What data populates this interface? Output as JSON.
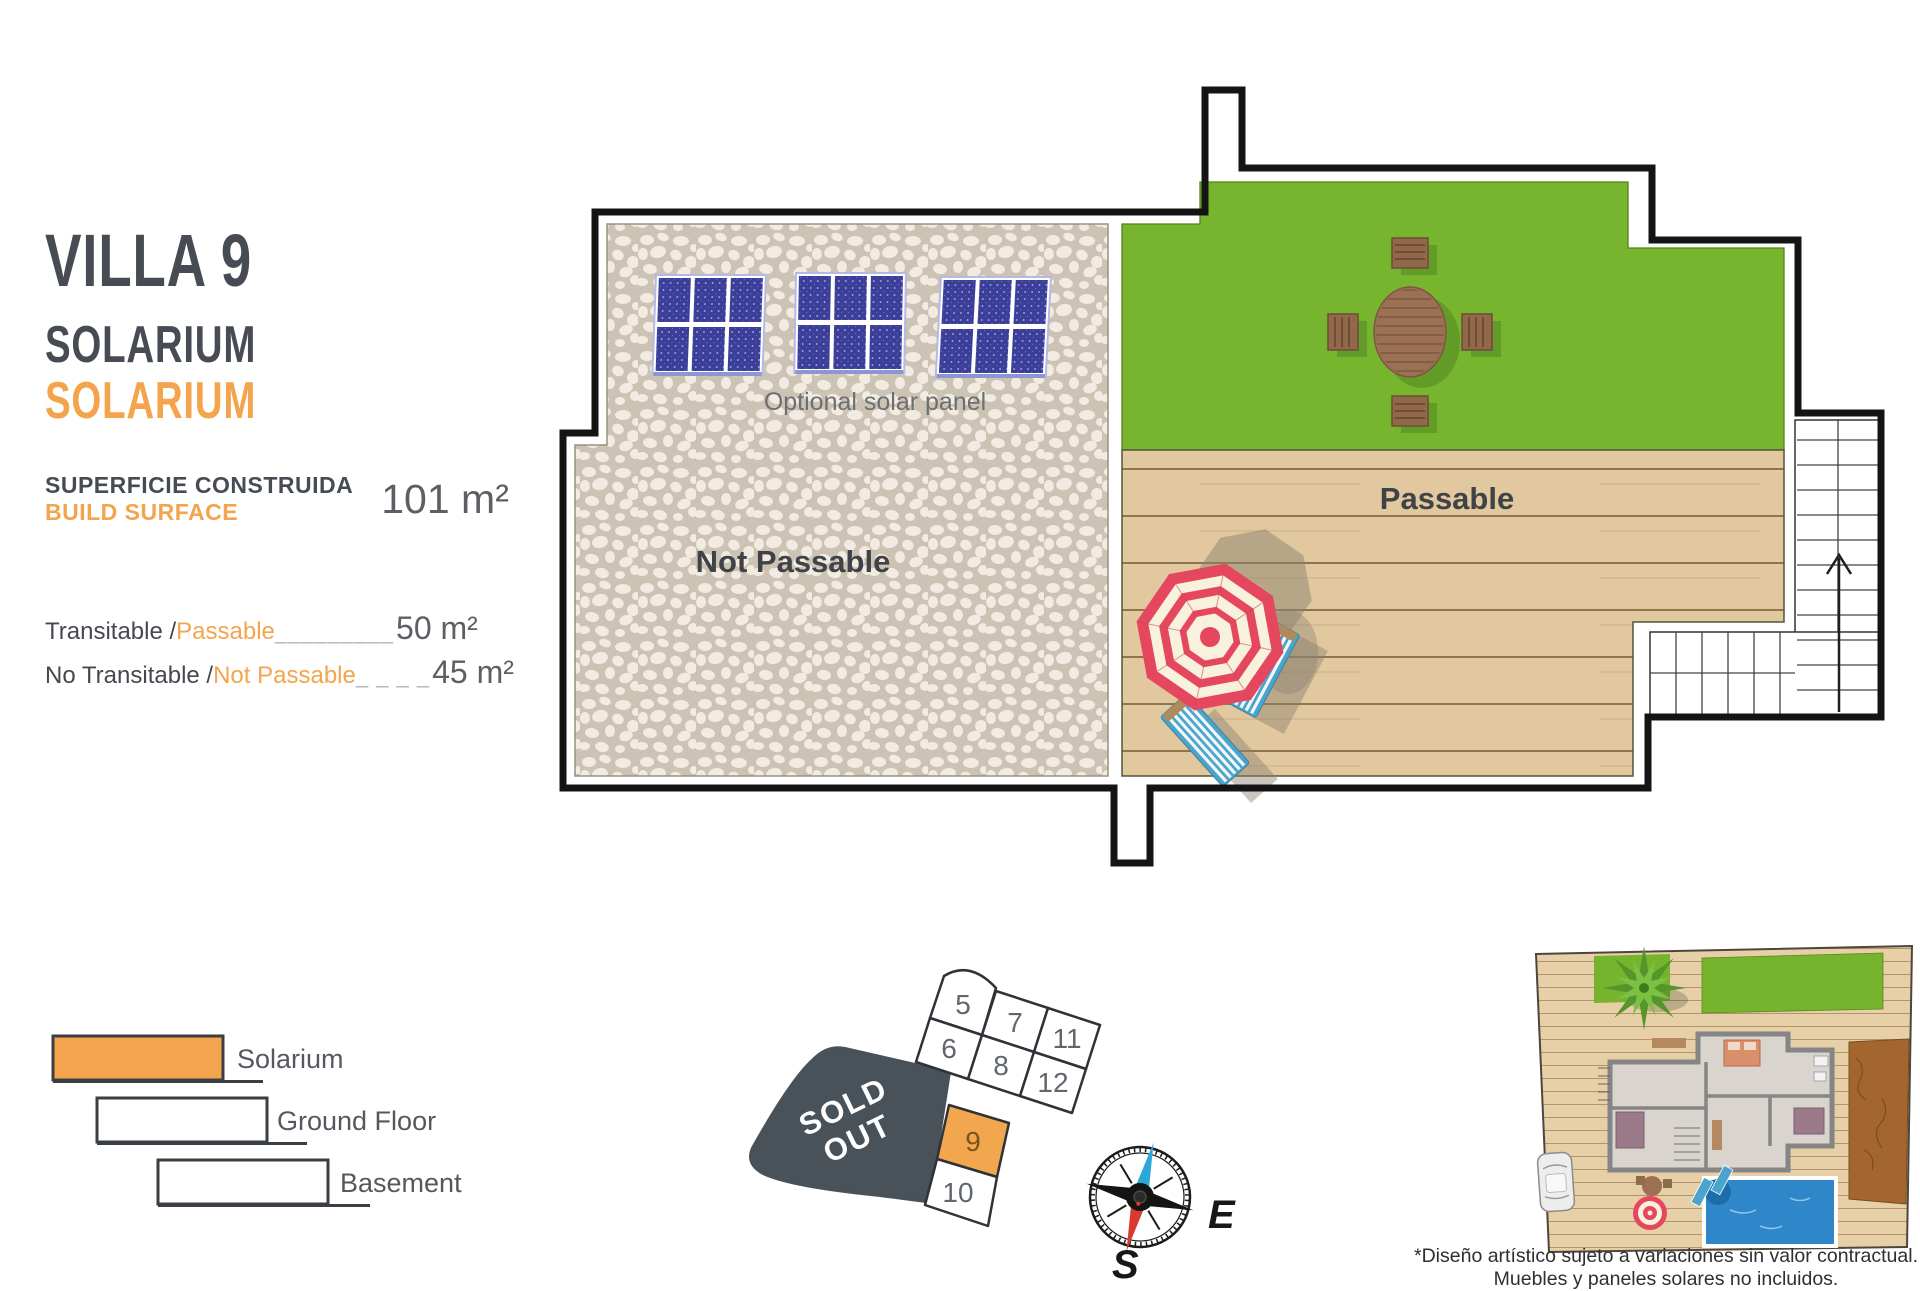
{
  "header": {
    "villa_title": "VILLA 9",
    "subtitle_es": "SOLARIUM",
    "subtitle_en": "SOLARIUM",
    "surface_label_es": "SUPERFICIE CONSTRUIDA",
    "surface_label_en": "BUILD SURFACE",
    "surface_value": "101 m²"
  },
  "measurements": {
    "rows": [
      {
        "label_es": "Transitable / ",
        "label_en": "Passable",
        "leader": "_________",
        "value": "50 m²"
      },
      {
        "label_es": "No Transitable / ",
        "label_en": "Not Passable",
        "leader": "_ _ _ _",
        "value": "45 m²"
      }
    ]
  },
  "plan_labels": {
    "optional_solar": "Optional solar panel",
    "not_passable": "Not Passable",
    "passable": "Passable"
  },
  "legend": {
    "items": [
      {
        "label": "Solarium",
        "highlighted": true
      },
      {
        "label": "Ground Floor",
        "highlighted": false
      },
      {
        "label": "Basement",
        "highlighted": false
      }
    ]
  },
  "plot_map": {
    "plots": [
      "5",
      "7",
      "11",
      "6",
      "8",
      "12",
      "9",
      "10"
    ],
    "highlighted_plot": "9",
    "sold_out_word1": "SOLD",
    "sold_out_word2": "OUT"
  },
  "compass": {
    "east": "E",
    "south": "S"
  },
  "disclaimer": {
    "line1": "*Diseño artístico sujeto a variaciones sin valor contractual.",
    "line2": "Muebles y paneles solares no incluidos."
  },
  "colors": {
    "accent_orange": "#f3a44c",
    "dark_text": "#474b54",
    "grass_green": "#78b52f",
    "deck_tan": "#e1c89e",
    "stone_bg": "#cdc3b4",
    "panel_blue": "#3c3f9a",
    "sold_out_gray": "#495159",
    "umbrella_red": "#e5485e",
    "lounger_blue": "#4ba4cb",
    "pool_blue": "#2f87c9"
  }
}
